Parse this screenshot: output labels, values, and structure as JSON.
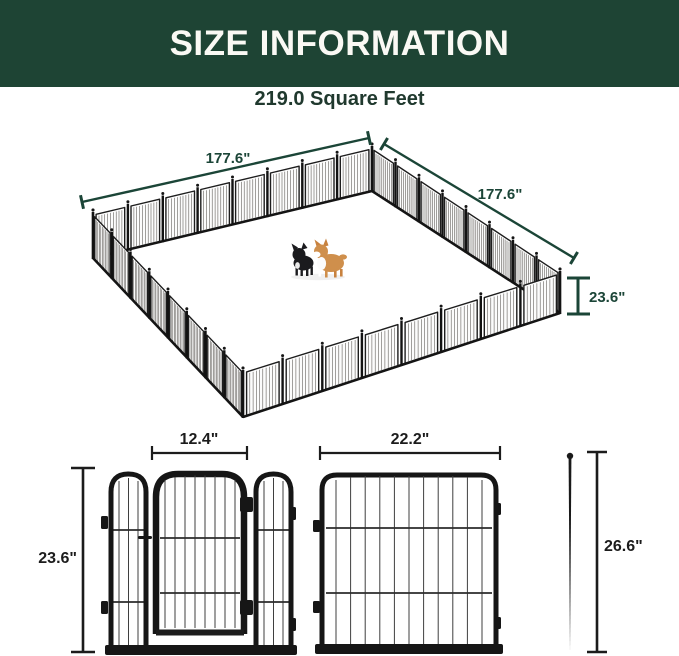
{
  "header": {
    "title": "SIZE INFORMATION"
  },
  "area": {
    "label": "219.0 Square Feet"
  },
  "pen": {
    "side_left_label": "177.6\"",
    "side_right_label": "177.6\"",
    "height_label": "23.6\""
  },
  "gate_panel": {
    "door_width_label": "12.4\"",
    "height_label": "23.6\""
  },
  "panel": {
    "width_label": "22.2\""
  },
  "stake": {
    "height_label": "26.6\""
  },
  "colors": {
    "header_bg": "#1e4434",
    "header_text": "#faf9f4",
    "dim_green": "#1b4537",
    "dim_black": "#1c1c1c",
    "fence_black": "#161616",
    "corgi_tan": "#cf8f4c"
  }
}
